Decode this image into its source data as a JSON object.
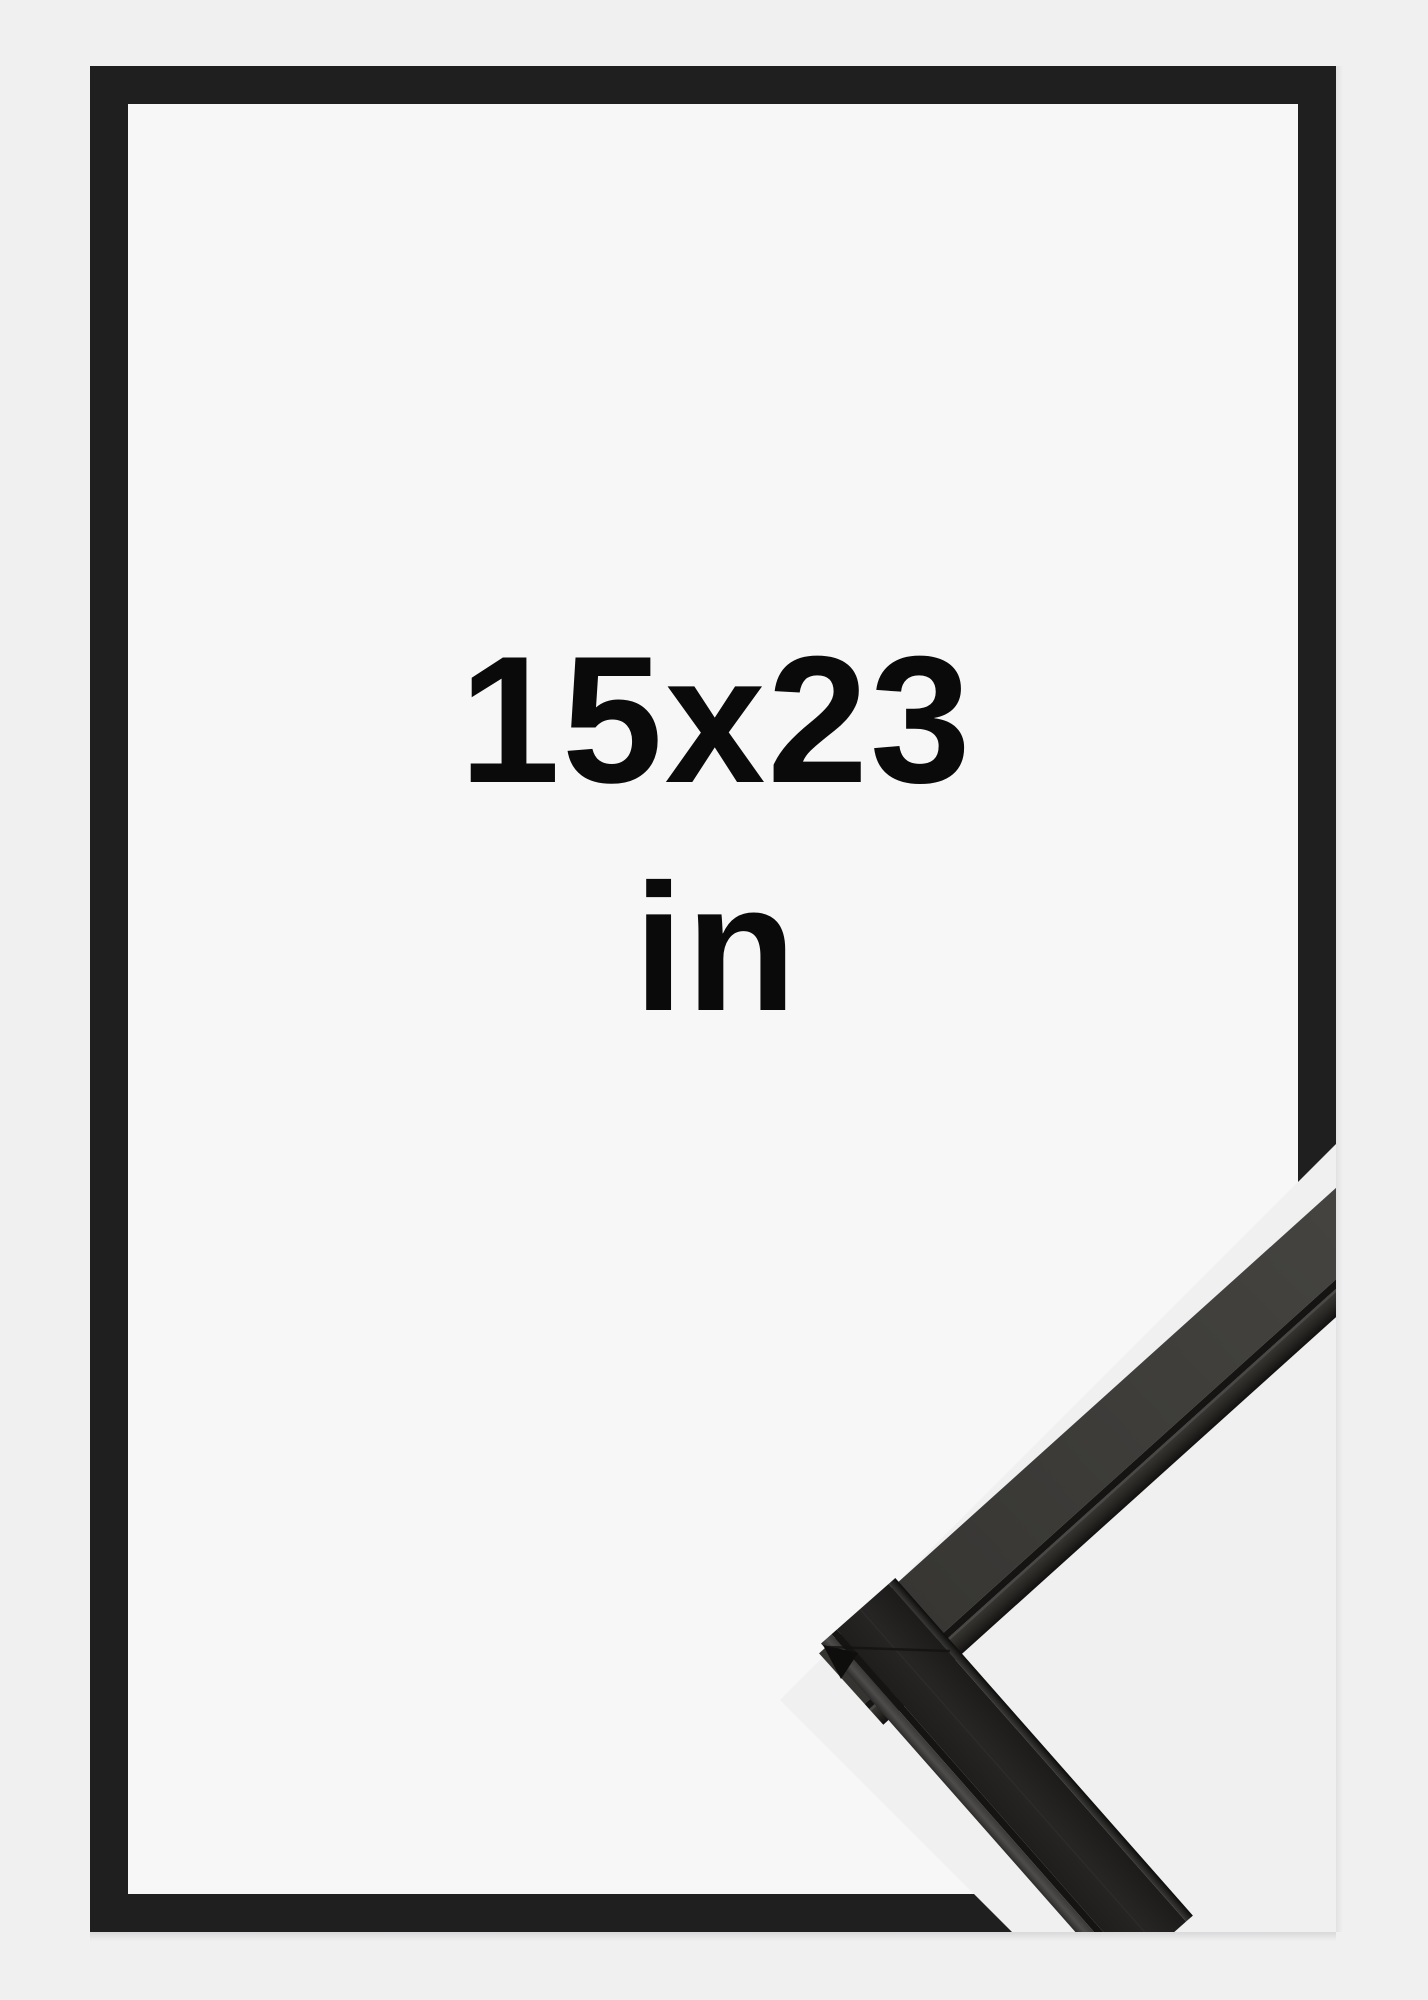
{
  "product": {
    "size_label": "15x23",
    "unit_label": "in",
    "frame_style": "black-wood-frame"
  },
  "colors": {
    "background": "#f0f0f1",
    "frame_opening": "#f7f7f8",
    "frame_black": "#1f1f1f",
    "text": "#0a0a0a",
    "profile_top_face": "#3d3c39",
    "profile_front_face": "#232221",
    "profile_groove": "#151413",
    "profile_bevel": "#4a4947"
  }
}
